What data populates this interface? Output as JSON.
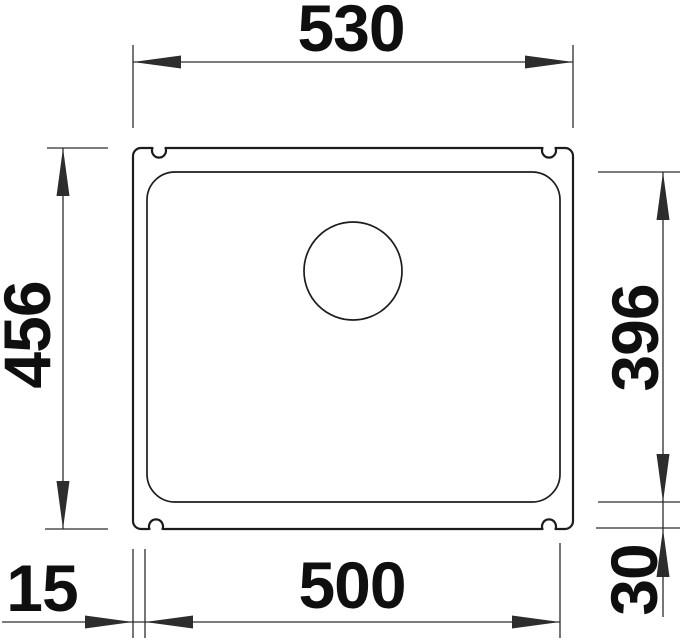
{
  "diagram": {
    "type": "technical-dimension-drawing",
    "subject": "undermount sink, top view",
    "labels": {
      "outer_width": "530",
      "outer_height": "456",
      "bowl_height": "396",
      "bowl_width": "500",
      "rim_left": "15",
      "rim_bottom": "30"
    },
    "colors": {
      "line": "#1c1c1c",
      "dimension": "#2d2d2d",
      "text": "#0f0f0f",
      "background": "#ffffff"
    }
  }
}
